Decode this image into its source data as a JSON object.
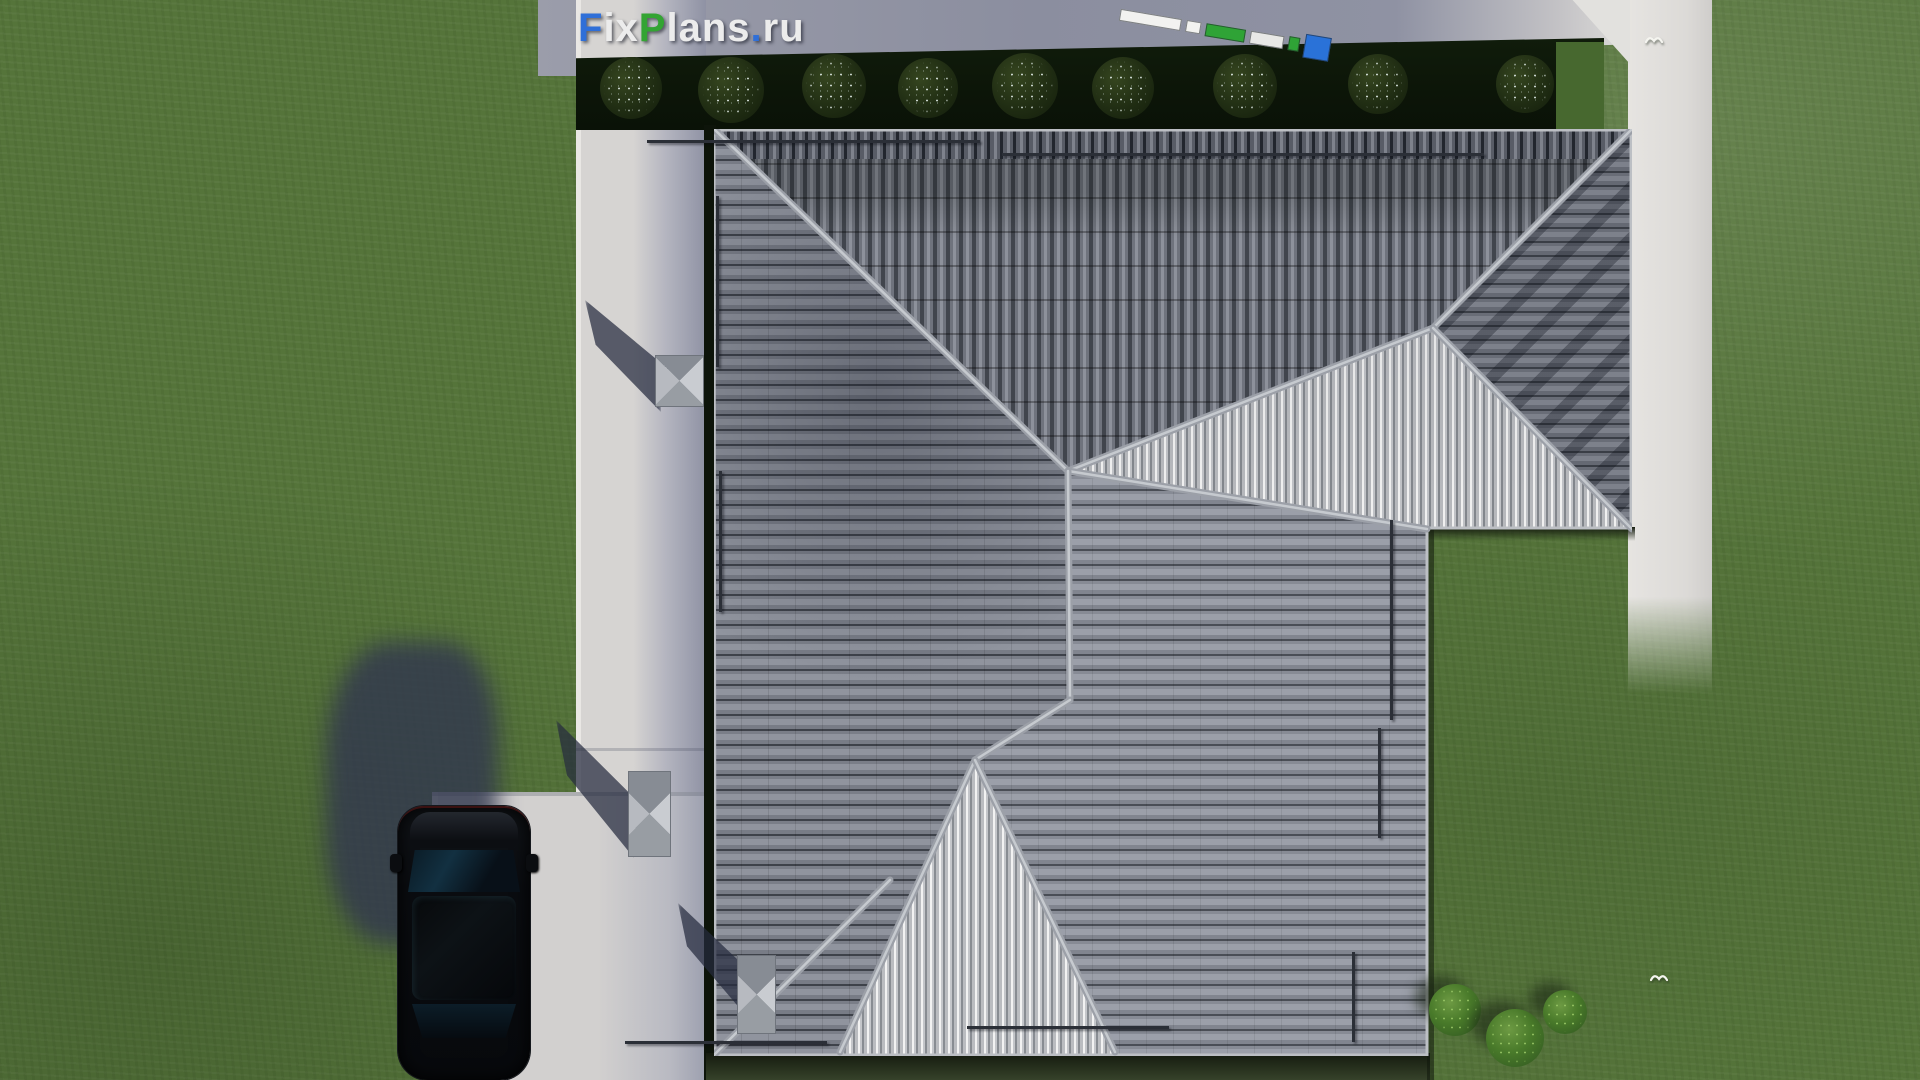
{
  "scene": {
    "description": "Top-down 3D architectural render: gray tiled hip roof house on a green lawn with concrete paths, driveway, black SUV, hedge of round bushes, two birds, FixPlans.ru watermark and measuring-tape graphic",
    "watermark": {
      "text": "FixPlans.ru",
      "segments": [
        {
          "t": "F",
          "c": "#2f6fd8"
        },
        {
          "t": "ix",
          "c": "#ececec"
        },
        {
          "t": "P",
          "c": "#33a433"
        },
        {
          "t": "lans",
          "c": "#ececec"
        },
        {
          "t": ".",
          "c": "#2f6fd8"
        },
        {
          "t": "ru",
          "c": "#ececec"
        }
      ]
    },
    "palette": {
      "grass": "#55743a",
      "path_bright": "#d5d3d1",
      "path_shadow": "#8f92a4",
      "roof_dark": "#565a64",
      "roof_mid": "#848892",
      "roof_ribbed_bright": "#e8e8ea",
      "hedge": "#0c1508",
      "ridge": "#a2a6ae",
      "car": "#0a0c10",
      "shadow": "#343b55",
      "tape_green": "#2fa336",
      "tape_blue": "#2a72d8"
    }
  },
  "hedge_bushes": [
    {
      "x": 631,
      "y": 88,
      "d": 62
    },
    {
      "x": 731,
      "y": 90,
      "d": 66
    },
    {
      "x": 834,
      "y": 86,
      "d": 64
    },
    {
      "x": 928,
      "y": 88,
      "d": 60
    },
    {
      "x": 1025,
      "y": 86,
      "d": 66
    },
    {
      "x": 1123,
      "y": 88,
      "d": 62
    },
    {
      "x": 1245,
      "y": 86,
      "d": 64
    },
    {
      "x": 1378,
      "y": 84,
      "d": 60
    },
    {
      "x": 1525,
      "y": 84,
      "d": 58
    }
  ],
  "garden_bushes": [
    {
      "x": 1455,
      "y": 1010,
      "d": 52
    },
    {
      "x": 1515,
      "y": 1038,
      "d": 58
    },
    {
      "x": 1565,
      "y": 1012,
      "d": 44
    }
  ],
  "birds": [
    {
      "x": 1645,
      "y": 34
    },
    {
      "x": 1650,
      "y": 972
    }
  ],
  "tape_segments": [
    {
      "c": "#f2f2f0",
      "w": 62,
      "h": 12
    },
    {
      "c": "#f2f2f0",
      "w": 15,
      "h": 12
    },
    {
      "c": "#2fa336",
      "w": 40,
      "h": 13
    },
    {
      "c": "#e8e8e6",
      "w": 34,
      "h": 13
    },
    {
      "c": "#2fa336",
      "w": 11,
      "h": 14
    },
    {
      "c": "#2a72d8",
      "w": 26,
      "h": 24
    }
  ],
  "snow_rails": {
    "horizontal": [
      {
        "x": 647,
        "y": 140,
        "w": 333
      },
      {
        "x": 1002,
        "y": 153,
        "w": 482
      },
      {
        "x": 625,
        "y": 1041,
        "w": 202
      },
      {
        "x": 967,
        "y": 1026,
        "w": 202
      }
    ],
    "vertical": [
      {
        "x": 716,
        "y": 196,
        "h": 171
      },
      {
        "x": 719,
        "y": 471,
        "h": 141
      },
      {
        "x": 1390,
        "y": 520,
        "h": 200
      },
      {
        "x": 1378,
        "y": 728,
        "h": 110
      },
      {
        "x": 1352,
        "y": 952,
        "h": 90
      }
    ]
  },
  "chimneys": [
    {
      "x": 655,
      "y": 355,
      "w": 49,
      "h": 52
    },
    {
      "x": 628,
      "y": 771,
      "w": 43,
      "h": 86
    },
    {
      "x": 737,
      "y": 955,
      "w": 39,
      "h": 79
    }
  ],
  "chimney_shadows": [
    {
      "x": 585,
      "y": 300,
      "w": 76,
      "h": 112
    },
    {
      "x": 556,
      "y": 720,
      "w": 78,
      "h": 138
    },
    {
      "x": 678,
      "y": 903,
      "w": 64,
      "h": 108
    }
  ],
  "ridge_lines": [
    "0,0 354,342",
    "354,342 719,199",
    "719,199 918,0",
    "719,199 918,400",
    "354,342 713,400",
    "354,342 356,571",
    "356,571 261,631",
    "261,631 126,923",
    "261,631 401,923",
    "0,926 176,751"
  ],
  "roof_outline": "0,1 917,1 917,399 713,399 713,926 1,926"
}
